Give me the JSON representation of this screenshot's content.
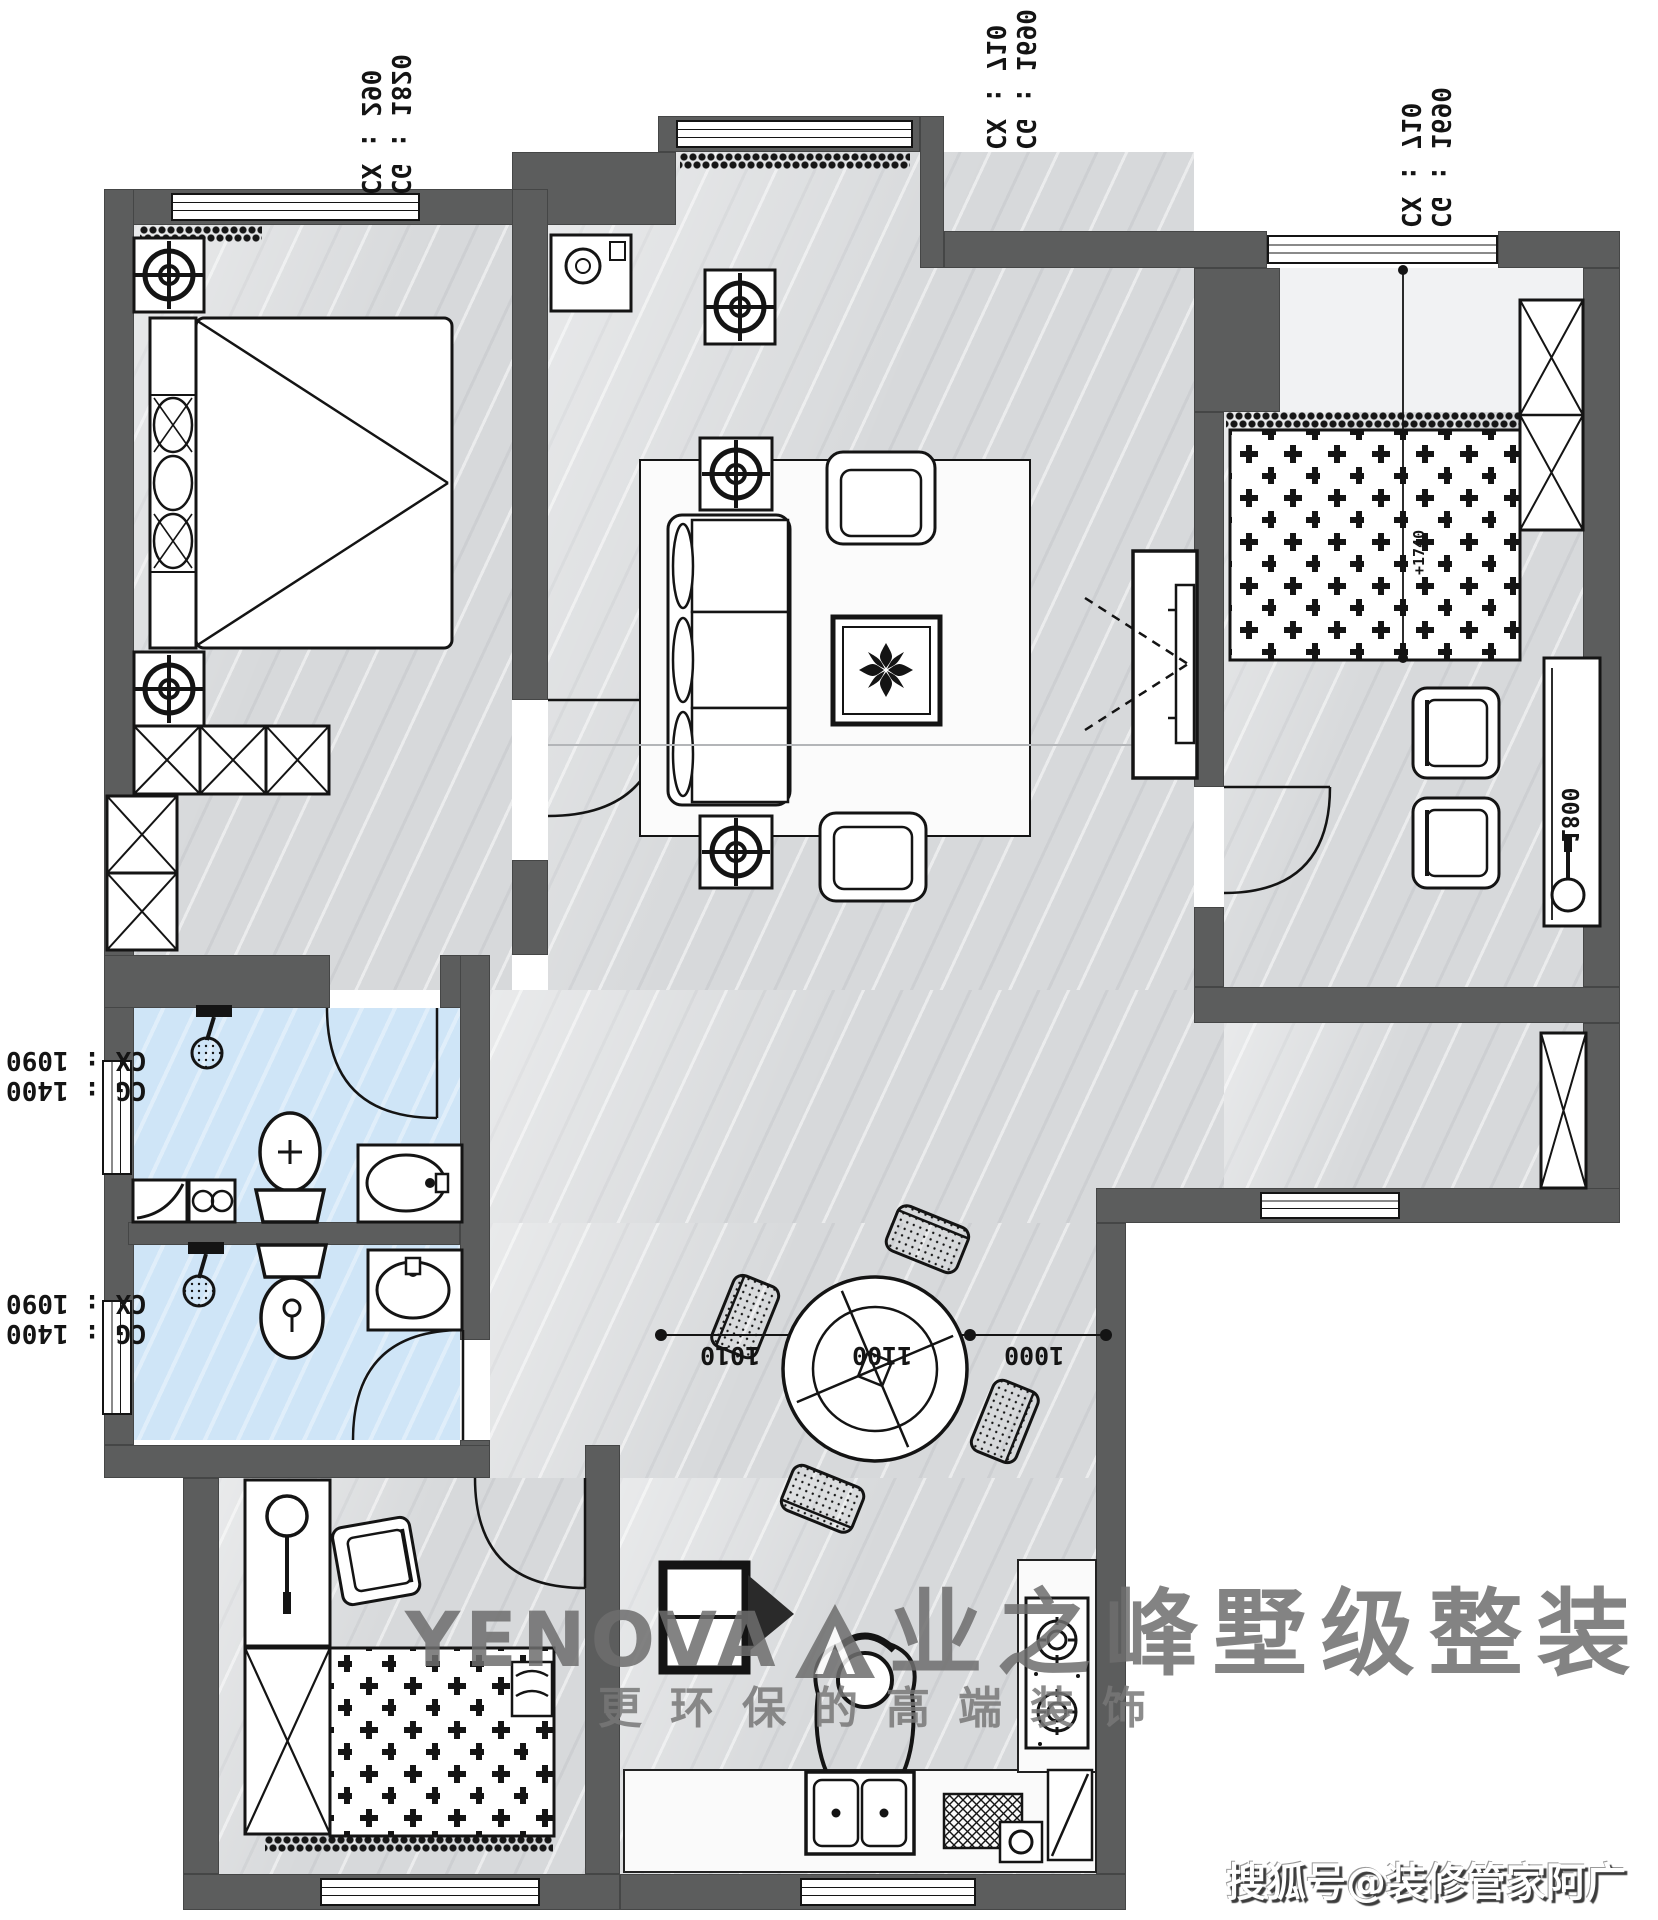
{
  "watermark": {
    "brand_latin": "YENOVA",
    "brand_cn": "业之峰墅级整装",
    "slogan": "更环保的高端装饰",
    "credit": "搜狐号@装修管家阿广"
  },
  "window_labels": {
    "top_left": {
      "line1": "CX : 290",
      "line2": "CG : 1820"
    },
    "top_middle": {
      "line1": "CX : 710",
      "line2": "CG : 1690"
    },
    "top_right": {
      "line1": "CX : 710",
      "line2": "CG : 1690"
    },
    "left_upper": {
      "line1": "CX : 1090",
      "line2": "CG : 1400"
    },
    "left_lower": {
      "line1": "CX : 1090",
      "line2": "CG : 1400"
    }
  },
  "dimensions": {
    "dining_segments": [
      "1010",
      "1100",
      "1000"
    ],
    "desk_length": "1800",
    "bed_marker": "+1740"
  },
  "colors": {
    "wall": "#5c5d5d",
    "floor": "#d7d9db",
    "bath_floor": "#cfe5f7",
    "watermark": "#6e6e6e"
  }
}
